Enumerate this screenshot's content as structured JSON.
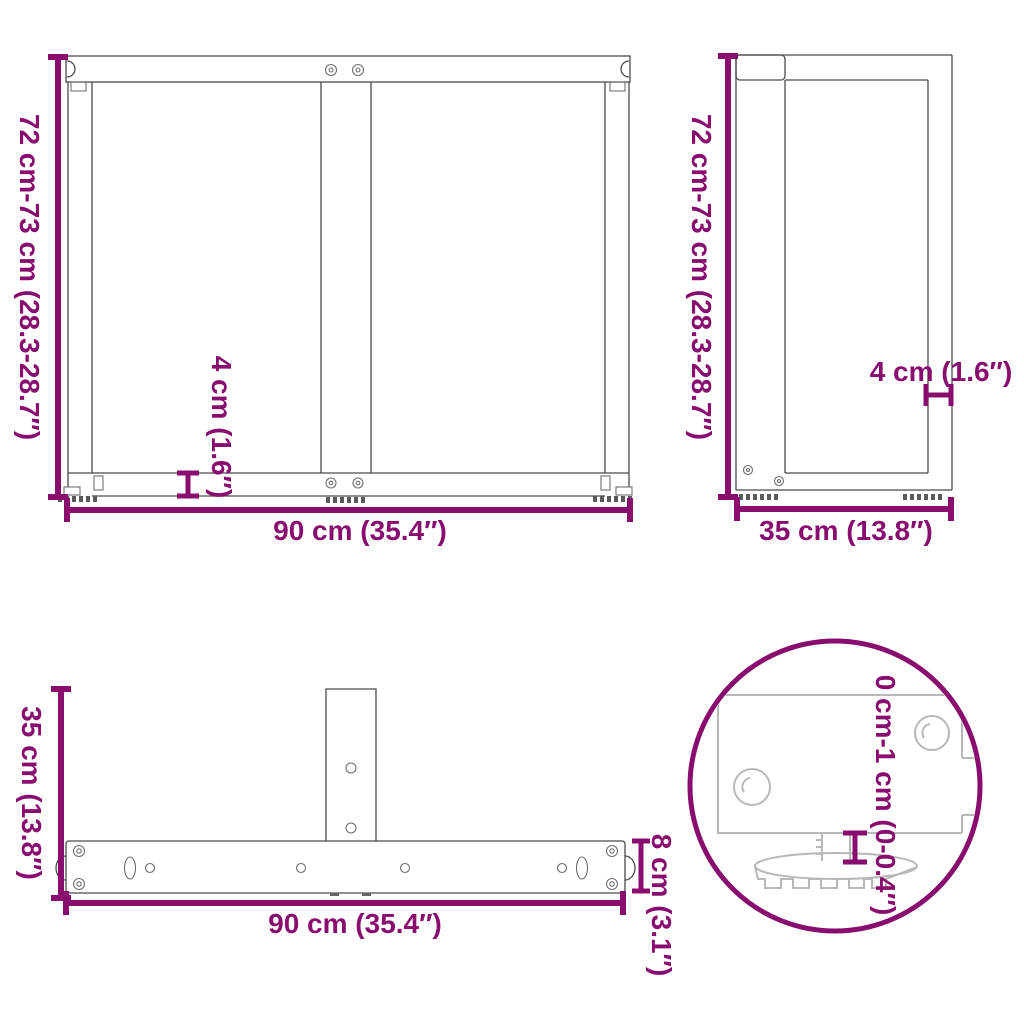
{
  "colors": {
    "dimension": "#880D6F",
    "drawing_line": "#4a4a4a",
    "detail_line": "#b8b8b8",
    "background": "#ffffff"
  },
  "views": {
    "front": {
      "height": "72 cm-73 cm (28.3-28.7″)",
      "width": "90 cm (35.4″)",
      "bar_thickness": "4 cm (1.6″)"
    },
    "side": {
      "height": "72 cm-73 cm (28.3-28.7″)",
      "depth": "35 cm (13.8″)",
      "lip": "4 cm (1.6″)"
    },
    "top": {
      "depth": "35 cm (13.8″)",
      "width": "90 cm (35.4″)",
      "bar_width": "8 cm (3.1″)"
    },
    "detail": {
      "foot_adjustment": "0 cm-1 cm (0-0.4″)"
    }
  }
}
